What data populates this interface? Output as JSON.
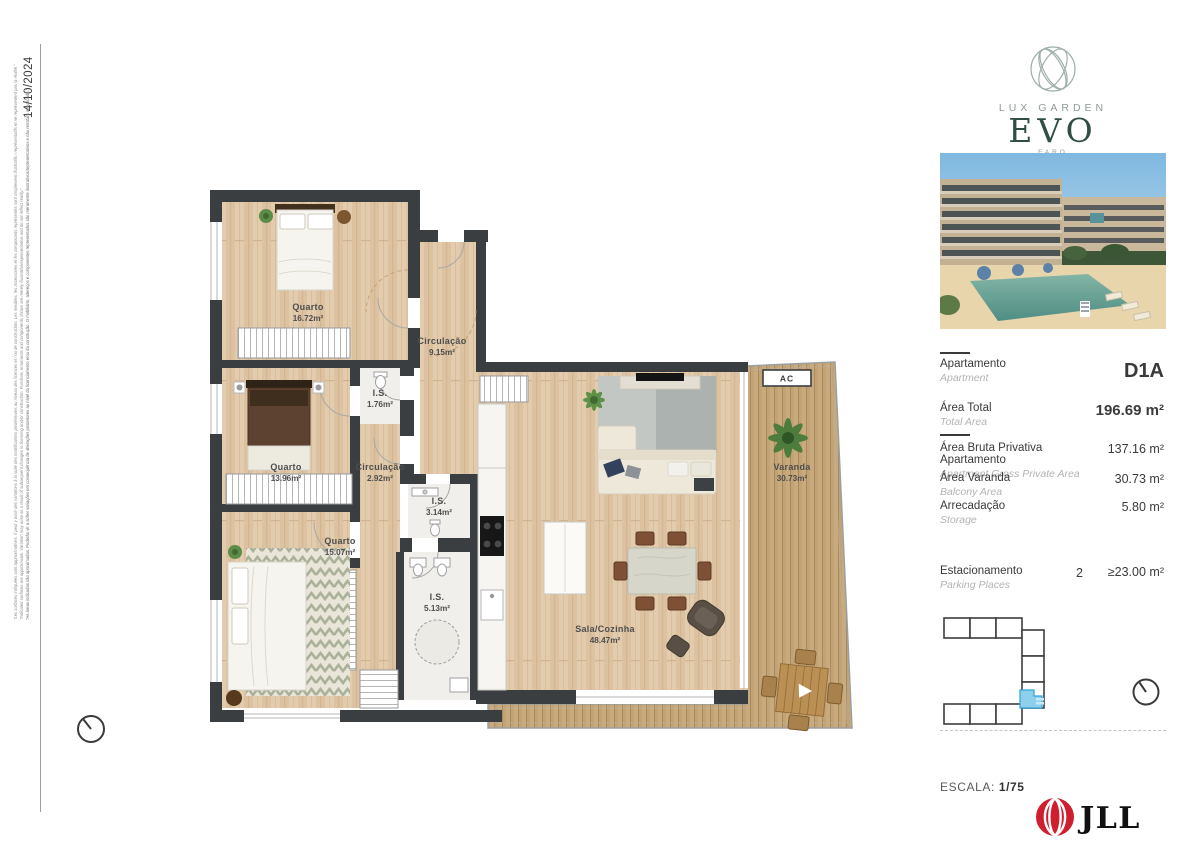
{
  "page": {
    "date": "14/10/2024"
  },
  "disclaimer": {
    "fr": "\"Les surfaces indiquées sont approximatives. Il peut y avoir des variations à la suite des modifications postérieures au niveau des licences et / ou de construction. Les meubles, les accessoires et les composants représentés sont simplement illustratifs / représentatifs et ne représentent pas la réalité.\"",
    "en": "\"Indicated surfaces are approximate. Variation may arise as a result of subsequent changes in licensing and/or construction. Furniture, ornaments and components shown are merely illustrative/representative and do not reflect reality.\"",
    "pt": "\"As áreas indicadas são aproximadas. Poderão vir a sofrer variações em consequência de alterações posteriores ao nível do licenciamento e/ou da construção. O mobiliário, adereços e componentes representados são meramente ilustrativos/representativos e não retratam a realidade.\""
  },
  "brand": {
    "line1": "LUX GARDEN",
    "name": "EVO",
    "sub": "FARO"
  },
  "specs": {
    "apartment": {
      "pt": "Apartamento",
      "en": "Apartment",
      "value": "D1A"
    },
    "total": {
      "pt": "Área Total",
      "en": "Total Area",
      "value": "196.69 m²"
    },
    "gross": {
      "pt": "Área Bruta Privativa Apartamento",
      "en": "Apartment Gross Private Area",
      "value": "137.16 m²"
    },
    "balcony": {
      "pt": "Área Varanda",
      "en": "Balcony Area",
      "value": "30.73 m²"
    },
    "storage": {
      "pt": "Arrecadação",
      "en": "Storage",
      "value": "5.80 m²"
    },
    "parking": {
      "pt": "Estacionamento",
      "en": "Parking Places",
      "count": "2",
      "value": "≥23.00 m²"
    }
  },
  "scale": {
    "label": "ESCALA:",
    "value": "1/75"
  },
  "agency": {
    "name": "JLL"
  },
  "floorplan": {
    "ac": "AC",
    "rooms": [
      {
        "name": "Quarto",
        "area": "16.72m²"
      },
      {
        "name": "Circulação",
        "area": "9.15m²"
      },
      {
        "name": "I.S.",
        "area": "1.76m²"
      },
      {
        "name": "Quarto",
        "area": "13.96m²"
      },
      {
        "name": "Circulação",
        "area": "2.92m²"
      },
      {
        "name": "I.S.",
        "area": "3.14m²"
      },
      {
        "name": "Quarto",
        "area": "15.07m²"
      },
      {
        "name": "I.S.",
        "area": "5.13m²"
      },
      {
        "name": "Sala/Cozinha",
        "area": "48.47m²"
      },
      {
        "name": "Varanda",
        "area": "30.73m²"
      }
    ]
  },
  "colors": {
    "wall": "#3b3e41",
    "wood": "#e0c7a8",
    "deck": "#c5a87d",
    "unit_highlight": "#8ecfec",
    "brand_green": "#2e4f41",
    "jll_red": "#cf1f2e"
  }
}
